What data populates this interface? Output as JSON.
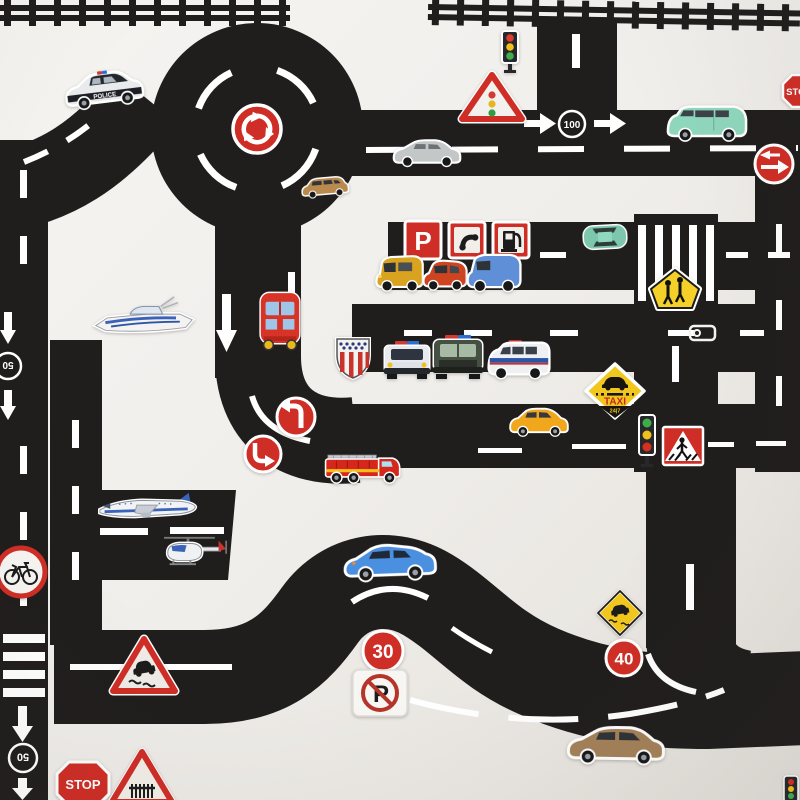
{
  "scene": {
    "kind": "photograph",
    "subject": "DIY black road-tape toy play mat with vehicle and traffic-sign stickers on white paper"
  },
  "colors": {
    "background": "#f1efec",
    "road": "#201e1d",
    "marking": "#ffffff",
    "sign_red": "#cf2e26",
    "sign_yellow": "#f2c71d",
    "sticker_border": "#ffffff",
    "taxi_black": "#18140f",
    "mint_van_green": "#8fd7bd",
    "police_blue": "#2b6fd4"
  },
  "labels": {
    "police": "POLICE",
    "stop": "STOP",
    "speed_100": "100",
    "speed_50": "50",
    "speed_30": "30",
    "speed_40": "40",
    "parking": "P",
    "no_parking": "P",
    "taxi": "TAXI",
    "taxi_hours": "24|7"
  },
  "signs": [
    {
      "name": "roundabout-sign"
    },
    {
      "name": "traffic-light-warning-triangle"
    },
    {
      "name": "stop-sign-right-edge",
      "label": "STOP"
    },
    {
      "name": "mandatory-arrows-sign"
    },
    {
      "name": "parking-sign",
      "label": "P"
    },
    {
      "name": "telephone-sign"
    },
    {
      "name": "fuel-station-sign"
    },
    {
      "name": "school-crossing-sign"
    },
    {
      "name": "us-route-shield-sticker"
    },
    {
      "name": "taxi-stand-sign",
      "label": "TAXI 24|7"
    },
    {
      "name": "pedestrian-crossing-sign"
    },
    {
      "name": "traffic-light-sticker-top"
    },
    {
      "name": "traffic-light-sticker-middle"
    },
    {
      "name": "traffic-light-sticker-corner"
    },
    {
      "name": "turn-left-sign-upper"
    },
    {
      "name": "turn-left-sign-lower"
    },
    {
      "name": "no-bicycles-sign"
    },
    {
      "name": "slippery-road-triangle-sign"
    },
    {
      "name": "slippery-road-diamond-sign"
    },
    {
      "name": "speed-limit-30-sign",
      "label": "30"
    },
    {
      "name": "no-parking-sticker",
      "label": "P"
    },
    {
      "name": "speed-limit-40-sign",
      "label": "40"
    },
    {
      "name": "stop-sign-bottom",
      "label": "STOP"
    },
    {
      "name": "railway-crossing-sign"
    }
  ],
  "vehicles": [
    {
      "name": "police-car",
      "label": "POLICE"
    },
    {
      "name": "station-wagon-tan"
    },
    {
      "name": "sedan-gray"
    },
    {
      "name": "minivan-mint"
    },
    {
      "name": "car-top-view-teal"
    },
    {
      "name": "van-yellow"
    },
    {
      "name": "car-red"
    },
    {
      "name": "van-blue"
    },
    {
      "name": "police-car-front"
    },
    {
      "name": "police-suv-front"
    },
    {
      "name": "police-van"
    },
    {
      "name": "city-bus-red"
    },
    {
      "name": "yacht"
    },
    {
      "name": "airliner"
    },
    {
      "name": "helicopter"
    },
    {
      "name": "fire-truck"
    },
    {
      "name": "car-yellow"
    },
    {
      "name": "sports-car-blue"
    },
    {
      "name": "sedan-brown"
    }
  ],
  "road_markings": {
    "speed_badge_100": "100",
    "speed_badge_50": "50",
    "railway_track": "top edge",
    "crosswalks": [
      "left vertical road",
      "middle right road"
    ]
  }
}
